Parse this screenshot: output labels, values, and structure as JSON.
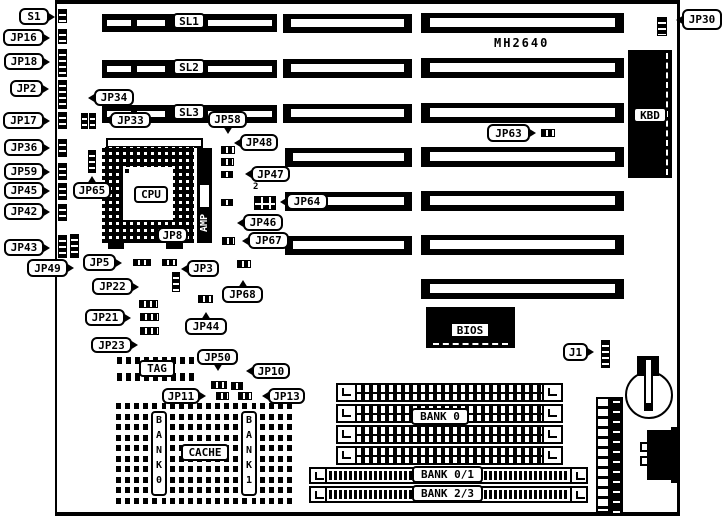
{
  "board": {
    "model": "MH2640"
  },
  "slots": {
    "sl1": "SL1",
    "sl2": "SL2",
    "sl3": "SL3"
  },
  "callouts": {
    "s1": "S1",
    "jp16": "JP16",
    "jp18": "JP18",
    "jp2": "JP2",
    "jp17": "JP17",
    "jp36": "JP36",
    "jp59": "JP59",
    "jp45": "JP45",
    "jp42": "JP42",
    "jp43": "JP43",
    "jp49": "JP49",
    "jp34": "JP34",
    "jp33": "JP33",
    "jp65": "JP65",
    "jp8": "JP8",
    "jp5": "JP5",
    "jp3": "JP3",
    "jp22": "JP22",
    "jp21": "JP21",
    "jp23": "JP23",
    "jp44": "JP44",
    "jp68": "JP68",
    "jp58": "JP58",
    "jp48": "JP48",
    "jp47": "JP47",
    "jp64": "JP64",
    "jp46": "JP46",
    "jp67": "JP67",
    "jp63": "JP63",
    "jp30": "JP30",
    "j1": "J1",
    "jp50": "JP50",
    "jp10": "JP10",
    "jp11": "JP11",
    "jp13": "JP13"
  },
  "components": {
    "cpu": "CPU",
    "amp": "AMP",
    "kbd": "KBD",
    "bios": "BIOS",
    "tag": "TAG",
    "cache": "CACHE",
    "bank0_vertical": "B\nA\nN\nK\n0",
    "bank1_vertical": "B\nA\nN\nK\n1",
    "bank0": "BANK 0",
    "bank01": "BANK 0/1",
    "bank23": "BANK 2/3"
  },
  "annotations": {
    "jp64_pin1": "2"
  },
  "colors": {
    "ink": "#000000",
    "paper": "#ffffff"
  }
}
